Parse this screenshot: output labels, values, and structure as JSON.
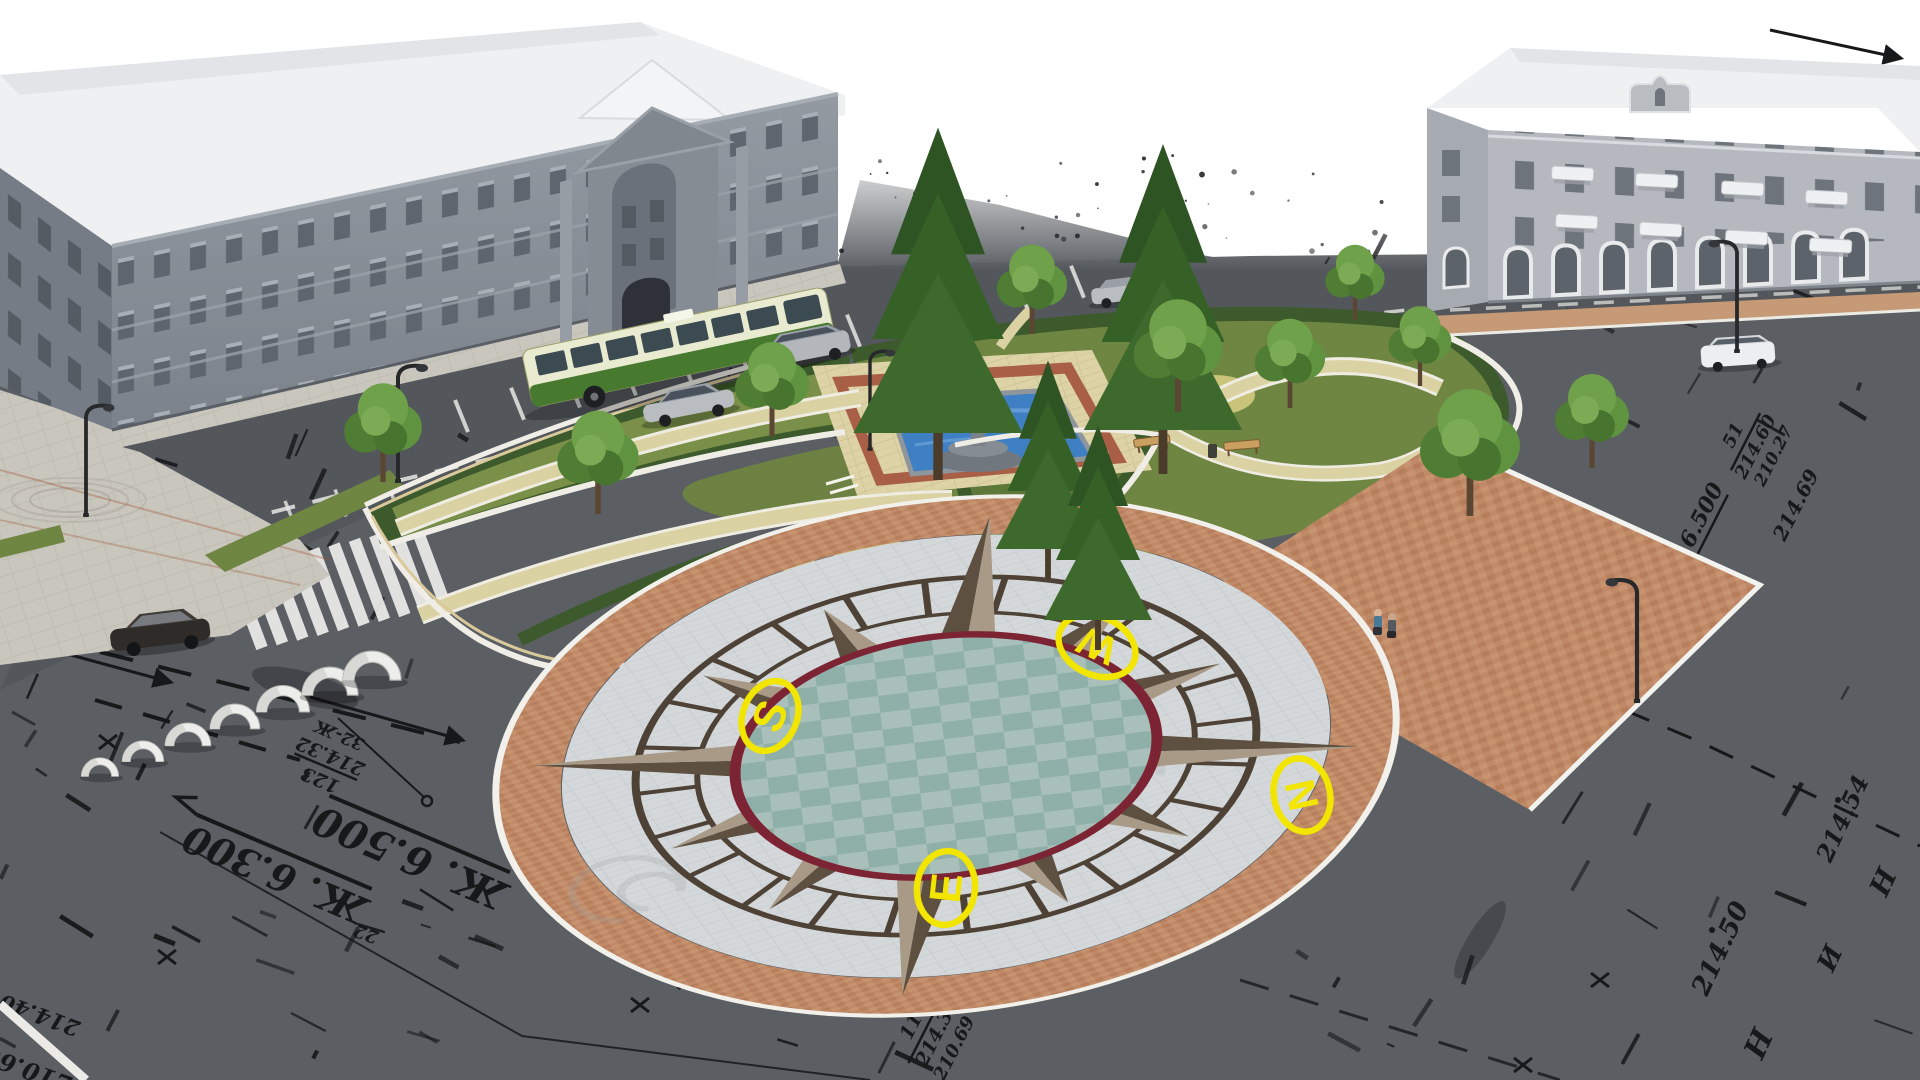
{
  "compass": {
    "south": "S",
    "west": "W",
    "north": "N",
    "east": "E"
  },
  "survey": {
    "zh_a": "Ж. 6.500",
    "zh_b": "Ж. 6.300",
    "zh_c": "Ж. 6.500",
    "st1": {
      "num": "123",
      "elev": "214.32",
      "note": "32-Ж"
    },
    "st2": {
      "num": "52",
      "elev": "214.65",
      "note": "210.34"
    },
    "st3": {
      "num": "51",
      "elev": "214.60",
      "note": "210.27"
    },
    "st4": {
      "num": "11",
      "elev": "214.3",
      "note": "210.69"
    },
    "spots": {
      "e69": "214.69",
      "e59": "214.59",
      "e54": "214.54",
      "e50": "214.50",
      "e40": "214.40",
      "e60": "210.60",
      "t22": "22",
      "t131": "131"
    },
    "letters": {
      "l1": "Н",
      "l2": "И",
      "l3": "Н"
    },
    "road_text": "НИНИН"
  },
  "colors": {
    "ink": "#17181a",
    "yellow": "#f2e500",
    "asphalt": "#5b5f64",
    "road": "#53575c",
    "pale": "#c9c6bd",
    "tan": "#ddd3a6",
    "brick": "#c08a68",
    "field": "#d4d8da",
    "teal": "#9db7b2",
    "rim": "#7c2433",
    "grass": "#6f8542",
    "grasslight": "#c9c47a",
    "hedge": "#3c5a2b",
    "curb": "#efede6",
    "curbtan": "#d9c99b",
    "roof": "#eef0f2",
    "bldgl": "#8b9199",
    "bldgl2": "#767c85",
    "bldgr": "#b5b9bf",
    "win": "#5f656e",
    "pool": "#3f7fc4",
    "stone": "#7e858c",
    "buscream": "#e8ebcf",
    "busgreen": "#47792f",
    "silver": "#b9bdc2",
    "darkcar": "#2f2b28",
    "redline": "#9c4a38",
    "compassdark": "#4e4236",
    "starlight": "#a89a86",
    "stardark": "#5e5040"
  }
}
